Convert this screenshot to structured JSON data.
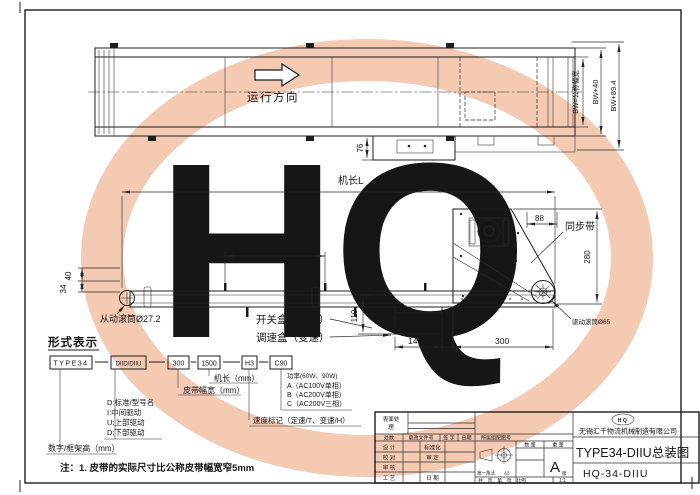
{
  "watermark": {
    "text": "HQ",
    "color": "#f2c2a9"
  },
  "plan": {
    "direction": "运行方向",
    "dim76": "76",
    "bw": "BW=公称幅宽",
    "bw40": "BW+40",
    "bw894": "BW+89.4"
  },
  "side": {
    "len": "机长L",
    "cleat": "挡条间距300",
    "d40": "40",
    "d34": "34",
    "driven": "从动滚筒Ø27.2",
    "switch_box": "开关盒（定速）",
    "speed_box": "调速盒（变速）",
    "d110": "110",
    "d88": "88",
    "timing": "同步带",
    "d280": "280",
    "drive": "驱动滚筒Ø65",
    "d140": "140",
    "d34b": "34",
    "d300": "300"
  },
  "form": {
    "title": "形式表示",
    "b1": "TYPE34",
    "b2": "DIID/DIIU",
    "b3": "300",
    "b4": "1500",
    "b5": "H3",
    "b6": "C90",
    "len_label": "机长（mm）",
    "width_label": "皮带幅宽（mm）",
    "leg1": "D:标准/型号名",
    "leg2": "I:中间驱动",
    "leg3": "U:上部驱动",
    "leg4": "D:下部驱动",
    "frame_label": "数字/框架高（mm）",
    "pow0": "功率(60W、90W)",
    "powA": "A（AC100V单相）",
    "powB": "B（AC200V单相）",
    "powC": "C（AC200V三相）",
    "speed_label": "速度标记（定速/T、变速/H）",
    "note": "注：1. 皮带的实际尺寸比公称皮带幅宽窄5mm"
  },
  "tb": {
    "surf1": "表面处",
    "surf2": "理",
    "h1": "处数",
    "h2": "更改文件号",
    "h3": "签 字",
    "h4": "日期",
    "belong": "所属组配图号",
    "f1": "设 计",
    "f2": "校 对",
    "f3": "审 核",
    "f4": "工 艺",
    "g1": "标准化",
    "g2": "审 定",
    "g4": "日 期",
    "proj": "第一角法",
    "size": "A3",
    "qty": "数 量",
    "wt": "重 量",
    "rev": "A",
    "rev2": "版",
    "pages": "共　页　第　页　比例",
    "scale": "1:1",
    "logo": "HQ",
    "company": "无锡汇千物流机械制造有限公司",
    "title": "TYPE34-DIIU总装图",
    "no": "HQ-34-DIIU"
  }
}
